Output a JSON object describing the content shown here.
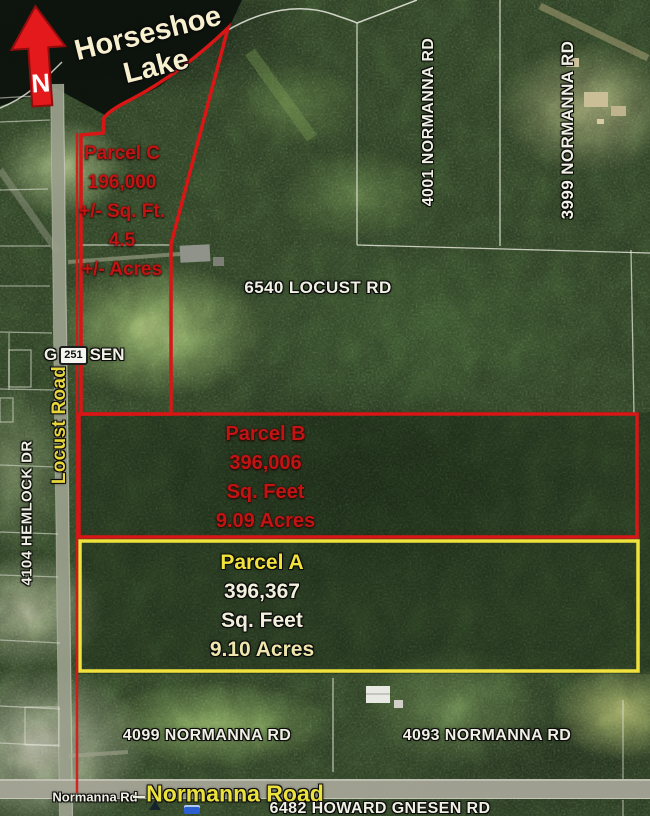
{
  "colors": {
    "parcel_red": "#d81616",
    "parcel_yellow": "#f0e23c",
    "label_white": "#f1f0e4",
    "label_yellow": "#ece23e",
    "red_text": "#c31414"
  },
  "compass": {
    "label": "N"
  },
  "lake": {
    "line1": "Horseshoe",
    "line2": "Lake"
  },
  "parcels": {
    "c": {
      "title": "Parcel C",
      "area": "196,000",
      "area_unit": "+/- Sq. Ft.",
      "acres": "4.5",
      "acres_unit": "+/- Acres"
    },
    "b": {
      "title": "Parcel B",
      "area": "396,006",
      "area_unit": "Sq. Feet",
      "acres": "9.09 Acres"
    },
    "a": {
      "title": "Parcel A",
      "area": "396,367",
      "area_unit": "Sq. Feet",
      "acres": "9.10 Acres"
    }
  },
  "addresses": {
    "normanna_4001": "4001 NORMANNA RD",
    "normanna_3999": "3999 NORMANNA RD",
    "locust_6540": "6540 LOCUST RD",
    "hemlock_4104": "4104 HEMLOCK DR",
    "normanna_4099": "4099 NORMANNA RD",
    "normanna_4093": "4093 NORMANNA RD",
    "howard_gnesen_6482": "6482 HOWARD GNESEN RD"
  },
  "roads": {
    "locust_label": "Locust Road",
    "normanna_label_small": "Normanna Rd",
    "normanna_label_large": "Normanna Road",
    "township_prefix": "G",
    "township_suffix": "SEN",
    "route_badge": "251"
  }
}
